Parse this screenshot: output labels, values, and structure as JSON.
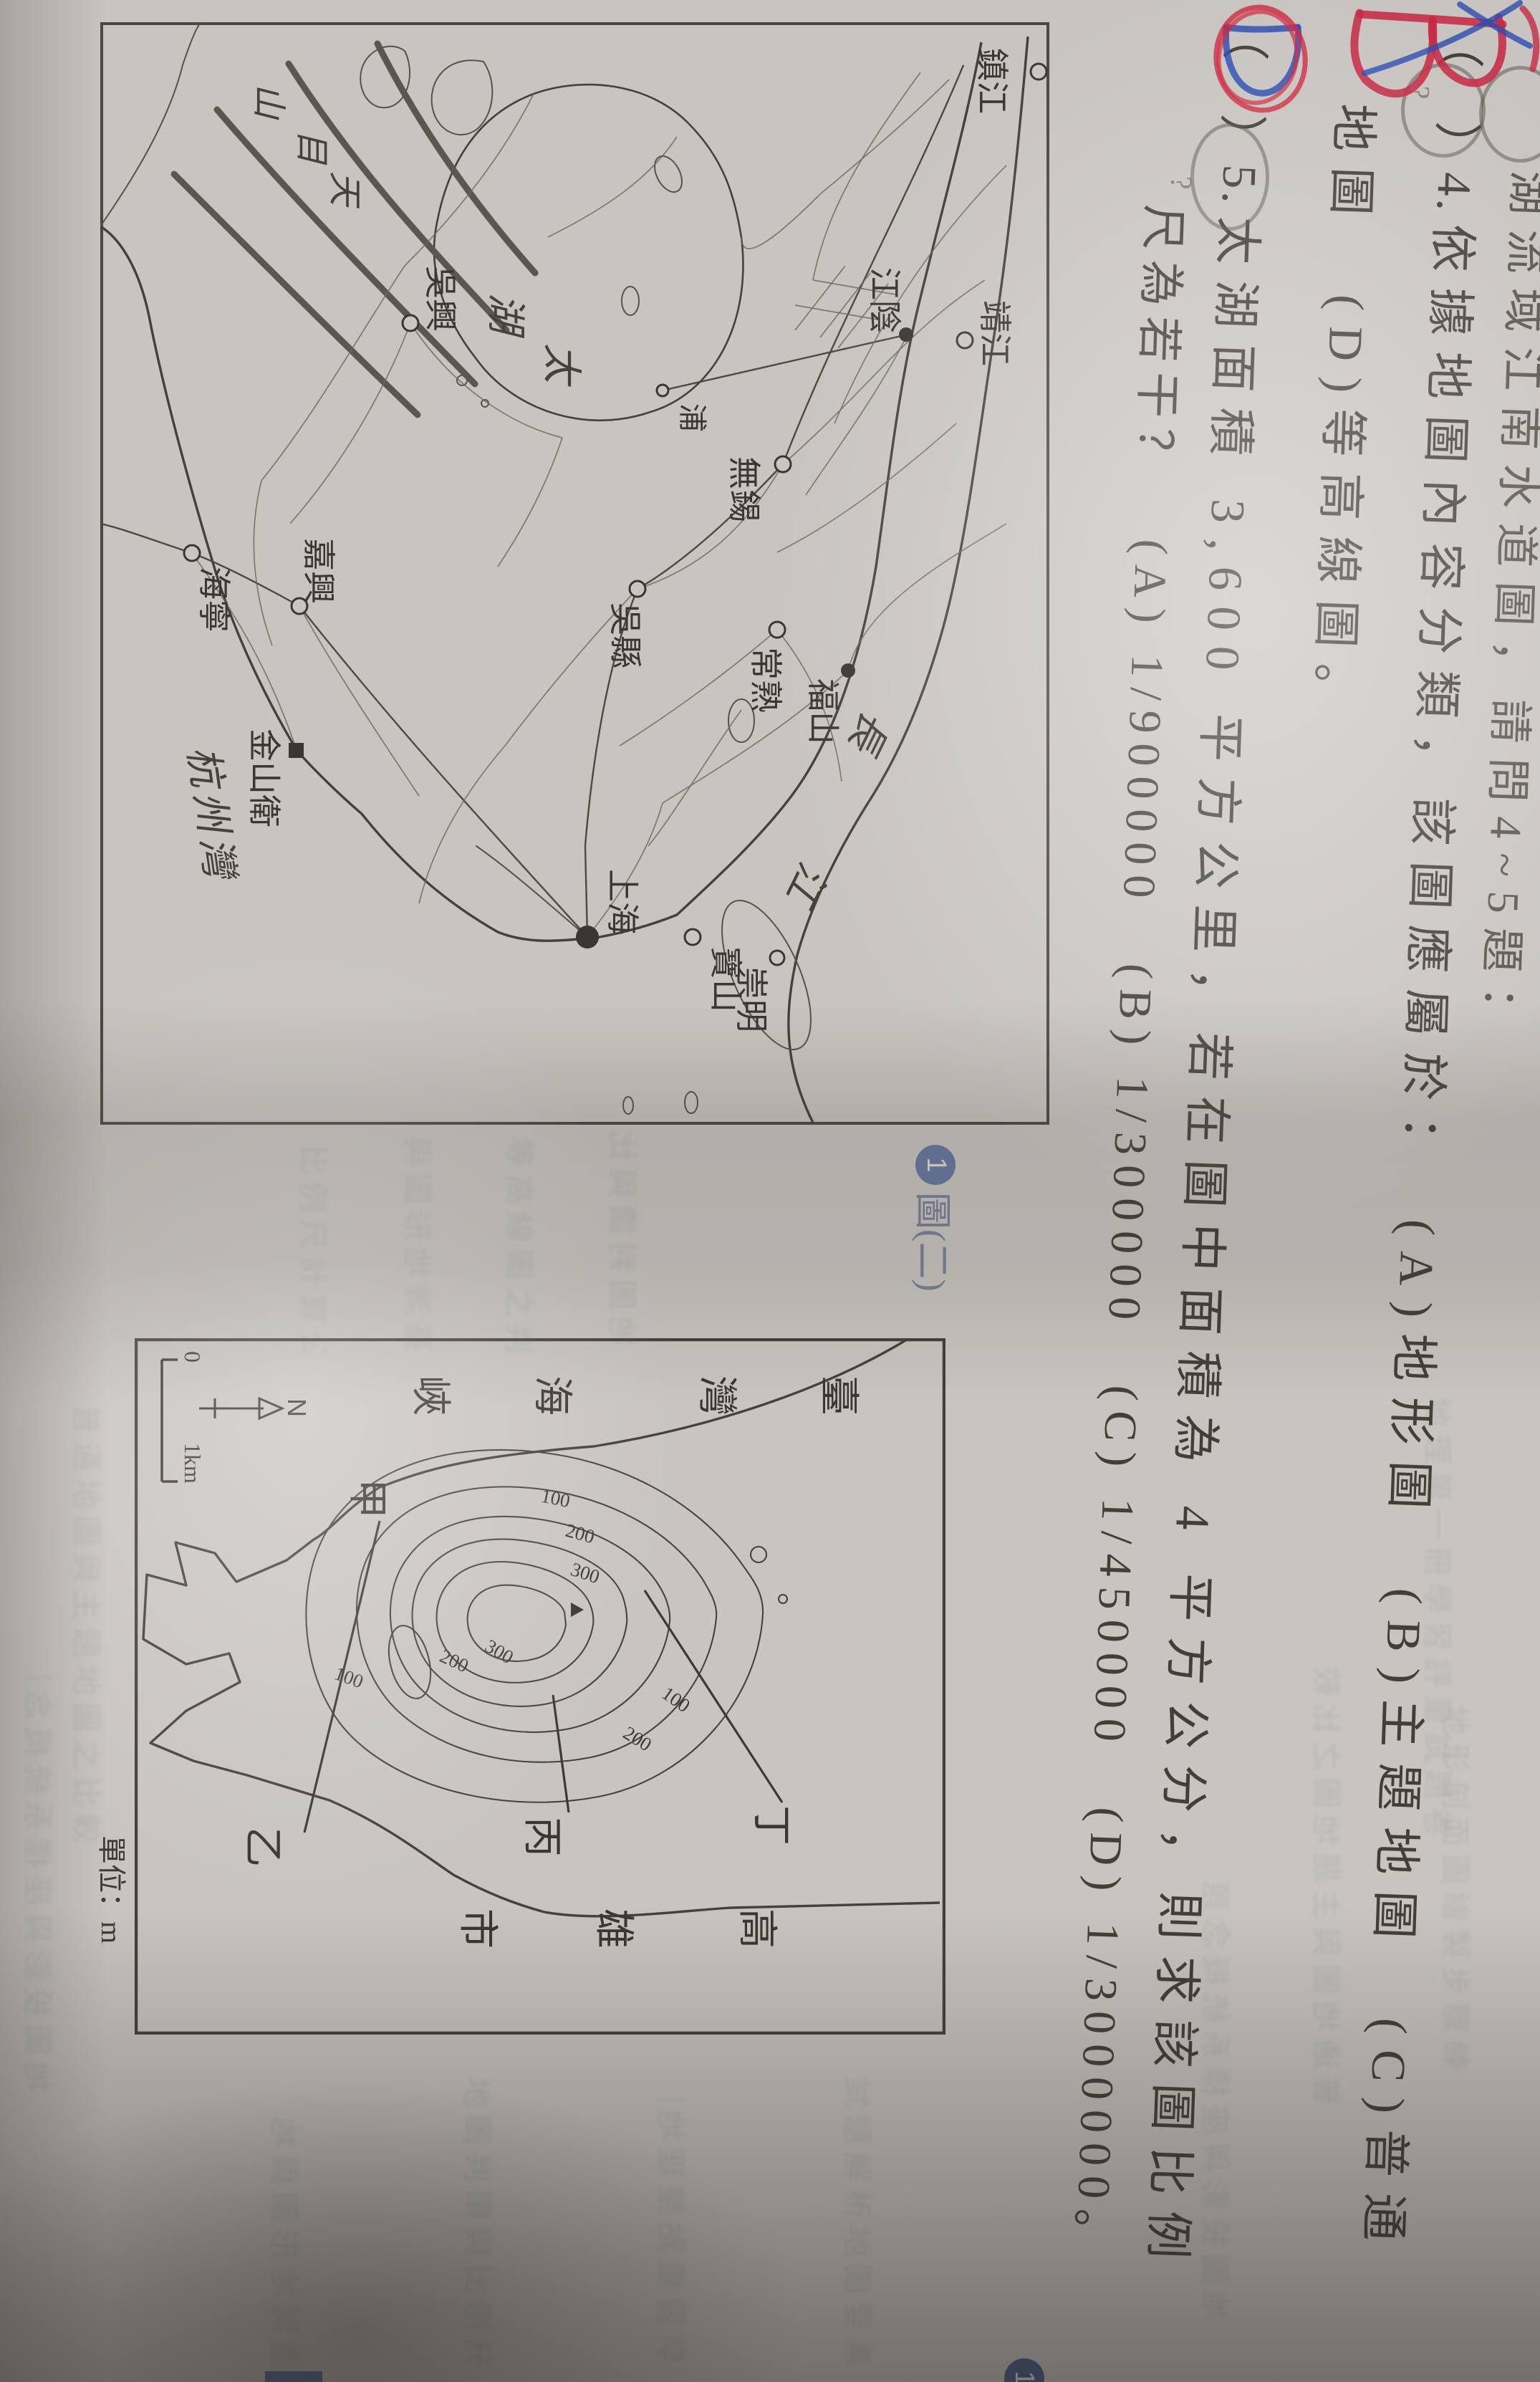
{
  "page": {
    "intro_cut_line": "湖流域江南水道圖，請問4~5題：",
    "q4": {
      "prefix": "（　）4.",
      "body": "依據地圖內容分類，該圖應屬於：　(A)地形圖　(B)主題地圖　(C)普通",
      "wrap": "地圖　(D)等高線圖。"
    },
    "q5": {
      "prefix": "（　）5.",
      "body": "太湖面積 3,600 平方公里，若在圖中面積為 4 平方公分，則求該圖比例",
      "wrap": "尺為若干？　(A) 1/900000　(B) 1/300000　(C) 1/450000　(D) 1/3000000。"
    },
    "handwriting": {
      "q4_answer": "B",
      "q5_answer": "D",
      "q4_query": "?",
      "q5_query": "?"
    }
  },
  "map1": {
    "cities": [
      {
        "label": "鎮江"
      },
      {
        "label": "靖江"
      },
      {
        "label": "江陰"
      },
      {
        "label": "無錫"
      },
      {
        "label": "常熟"
      },
      {
        "label": "福山"
      },
      {
        "label": "吳縣"
      },
      {
        "label": "吳興"
      },
      {
        "label": "上海"
      },
      {
        "label": "寶山"
      },
      {
        "label": "崇明"
      },
      {
        "label": "嘉興"
      },
      {
        "label": "海寧"
      },
      {
        "label": "金山衛"
      },
      {
        "label": "浦"
      }
    ],
    "river_label": [
      "長",
      "江"
    ],
    "lake_label": [
      "太",
      "湖"
    ],
    "bay_label": "杭州灣",
    "mountain_label": [
      "天",
      "目",
      "山"
    ]
  },
  "map2": {
    "sea_label": [
      "臺",
      "灣",
      "海",
      "峽"
    ],
    "city_label": [
      "高",
      "雄",
      "市"
    ],
    "points": [
      "甲",
      "乙",
      "丙",
      "丁"
    ],
    "contours": [
      "100",
      "200",
      "300",
      "300",
      "200",
      "100",
      "100",
      "200"
    ],
    "north": "N",
    "scale_zero": "0",
    "scale_km": "1km",
    "unit_note": "單位：m"
  },
  "captions": {
    "badge": "1",
    "figure": "圖(二)",
    "badge2": "1"
  },
  "ghost": [
    "地圖判讀與比例尺換算練習",
    "等高線圖之判讀方法說明複習",
    "臺灣地形圖與地圖分類整理",
    "比例尺計算公式整理與複習",
    "地理第一冊學習評量試題卷",
    "普通地圖與主題地圖之比較",
    "地形剖面圖繪製步驟練習題",
    "地圖投影與座標系統概念題",
    "試題解析地圖要素方向圖例",
    "學習重點整理地圖概念複習"
  ]
}
